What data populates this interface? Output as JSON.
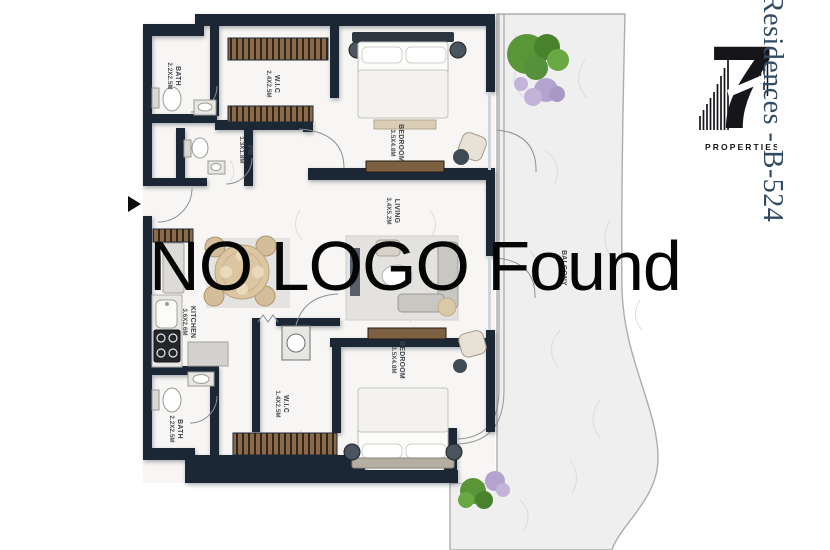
{
  "watermark": {
    "text": "NO LOGO Found"
  },
  "branding": {
    "side_text": "Residences - B-524",
    "logo_numeral": "7",
    "logo_subtext": "PROPERTIES"
  },
  "colors": {
    "wall": "#1c2735",
    "floor": "#f7f6f4",
    "terrace": "#f0eff0",
    "wood": "#8a6a49",
    "side_text": "#324a63",
    "watermark": "#050505"
  },
  "floorplan": {
    "rooms": [
      {
        "id": "bath-1",
        "name": "BATH",
        "dims": "2.2X2.5M"
      },
      {
        "id": "wic-1",
        "name": "W.I.C",
        "dims": "2.4X2.5M"
      },
      {
        "id": "powder-room",
        "name": "PR",
        "dims": "1.3X1.8M"
      },
      {
        "id": "bedroom-1",
        "name": "BEDROOM",
        "dims": "3.5X4.8M"
      },
      {
        "id": "living",
        "name": "LIVING",
        "dims": "3.4X5.2M"
      },
      {
        "id": "kitchen",
        "name": "KITCHEN",
        "dims": "3.6X2.6M"
      },
      {
        "id": "wic-2",
        "name": "W.I.C",
        "dims": "1.4X2.5M"
      },
      {
        "id": "bath-2",
        "name": "BATH",
        "dims": "2.2X2.5M"
      },
      {
        "id": "bedroom-2",
        "name": "BEDROOM",
        "dims": "3.5X4.8M"
      },
      {
        "id": "balcony",
        "name": "BALCONY",
        "dims": ""
      }
    ]
  }
}
